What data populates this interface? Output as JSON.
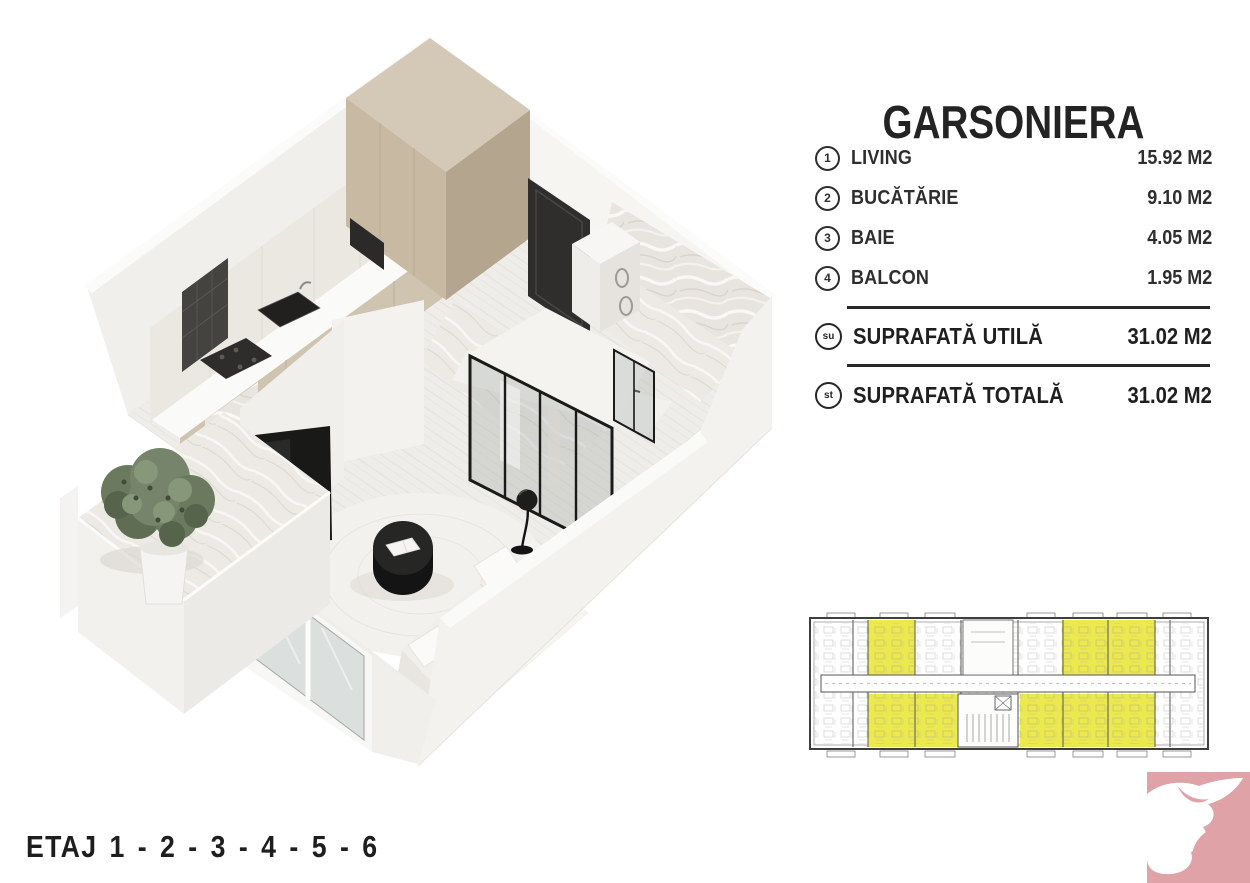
{
  "unit": {
    "title": "GARSONIERA",
    "rooms": [
      {
        "num": "1",
        "label": "LIVING",
        "area": "15.92 M2"
      },
      {
        "num": "2",
        "label": "BUCĂTĂRIE",
        "area": "9.10 M2"
      },
      {
        "num": "3",
        "label": "BAIE",
        "area": "4.05 M2"
      },
      {
        "num": "4",
        "label": "BALCON",
        "area": "1.95 M2"
      }
    ],
    "totals": [
      {
        "abbr": "su",
        "label": "SUPRAFATĂ UTILĂ",
        "area": "31.02 M2"
      },
      {
        "abbr": "st",
        "label": "SUPRAFATĂ TOTALĂ",
        "area": "31.02 M2"
      }
    ]
  },
  "footer": {
    "floors_label": "ETAJ 1 - 2 - 3 - 4 - 5 - 6"
  },
  "mini_plan": {
    "type": "building-level-plan",
    "highlighted_unit_count": 8,
    "highlight_color": "#ece94f"
  },
  "colors": {
    "ink": "#232323",
    "plan_highlight": "#ece94f",
    "logo_pink": "#dfa2a6",
    "cabinet_beige": "#c7b9a2",
    "render_dark": "#2c2b29"
  },
  "icons": {
    "logo": "dove-icon",
    "room_markers": "circled-number",
    "total_markers": "circled-abbreviation"
  }
}
